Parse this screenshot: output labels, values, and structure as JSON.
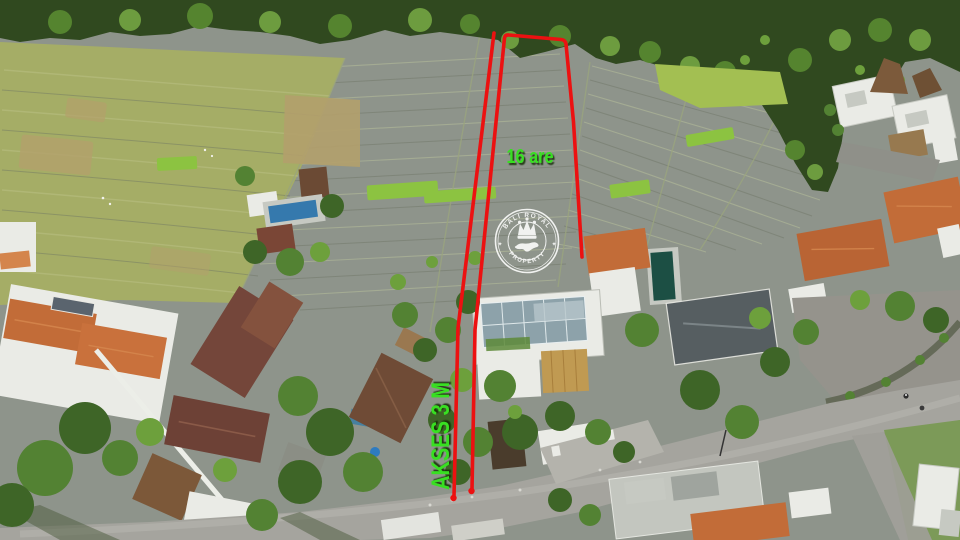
{
  "annotations": {
    "area_label": "16 are",
    "access_label": "AKSES 3 M",
    "label_color": "#38df22",
    "boundary_color": "#ec1111"
  },
  "watermark": {
    "brand_top": "BALI ROYAL",
    "brand_bottom": "PROPERTY",
    "separator": "✦",
    "color": "#ffffff",
    "icons": {
      "crown": "crown-icon",
      "island": "bali-island-icon"
    }
  }
}
